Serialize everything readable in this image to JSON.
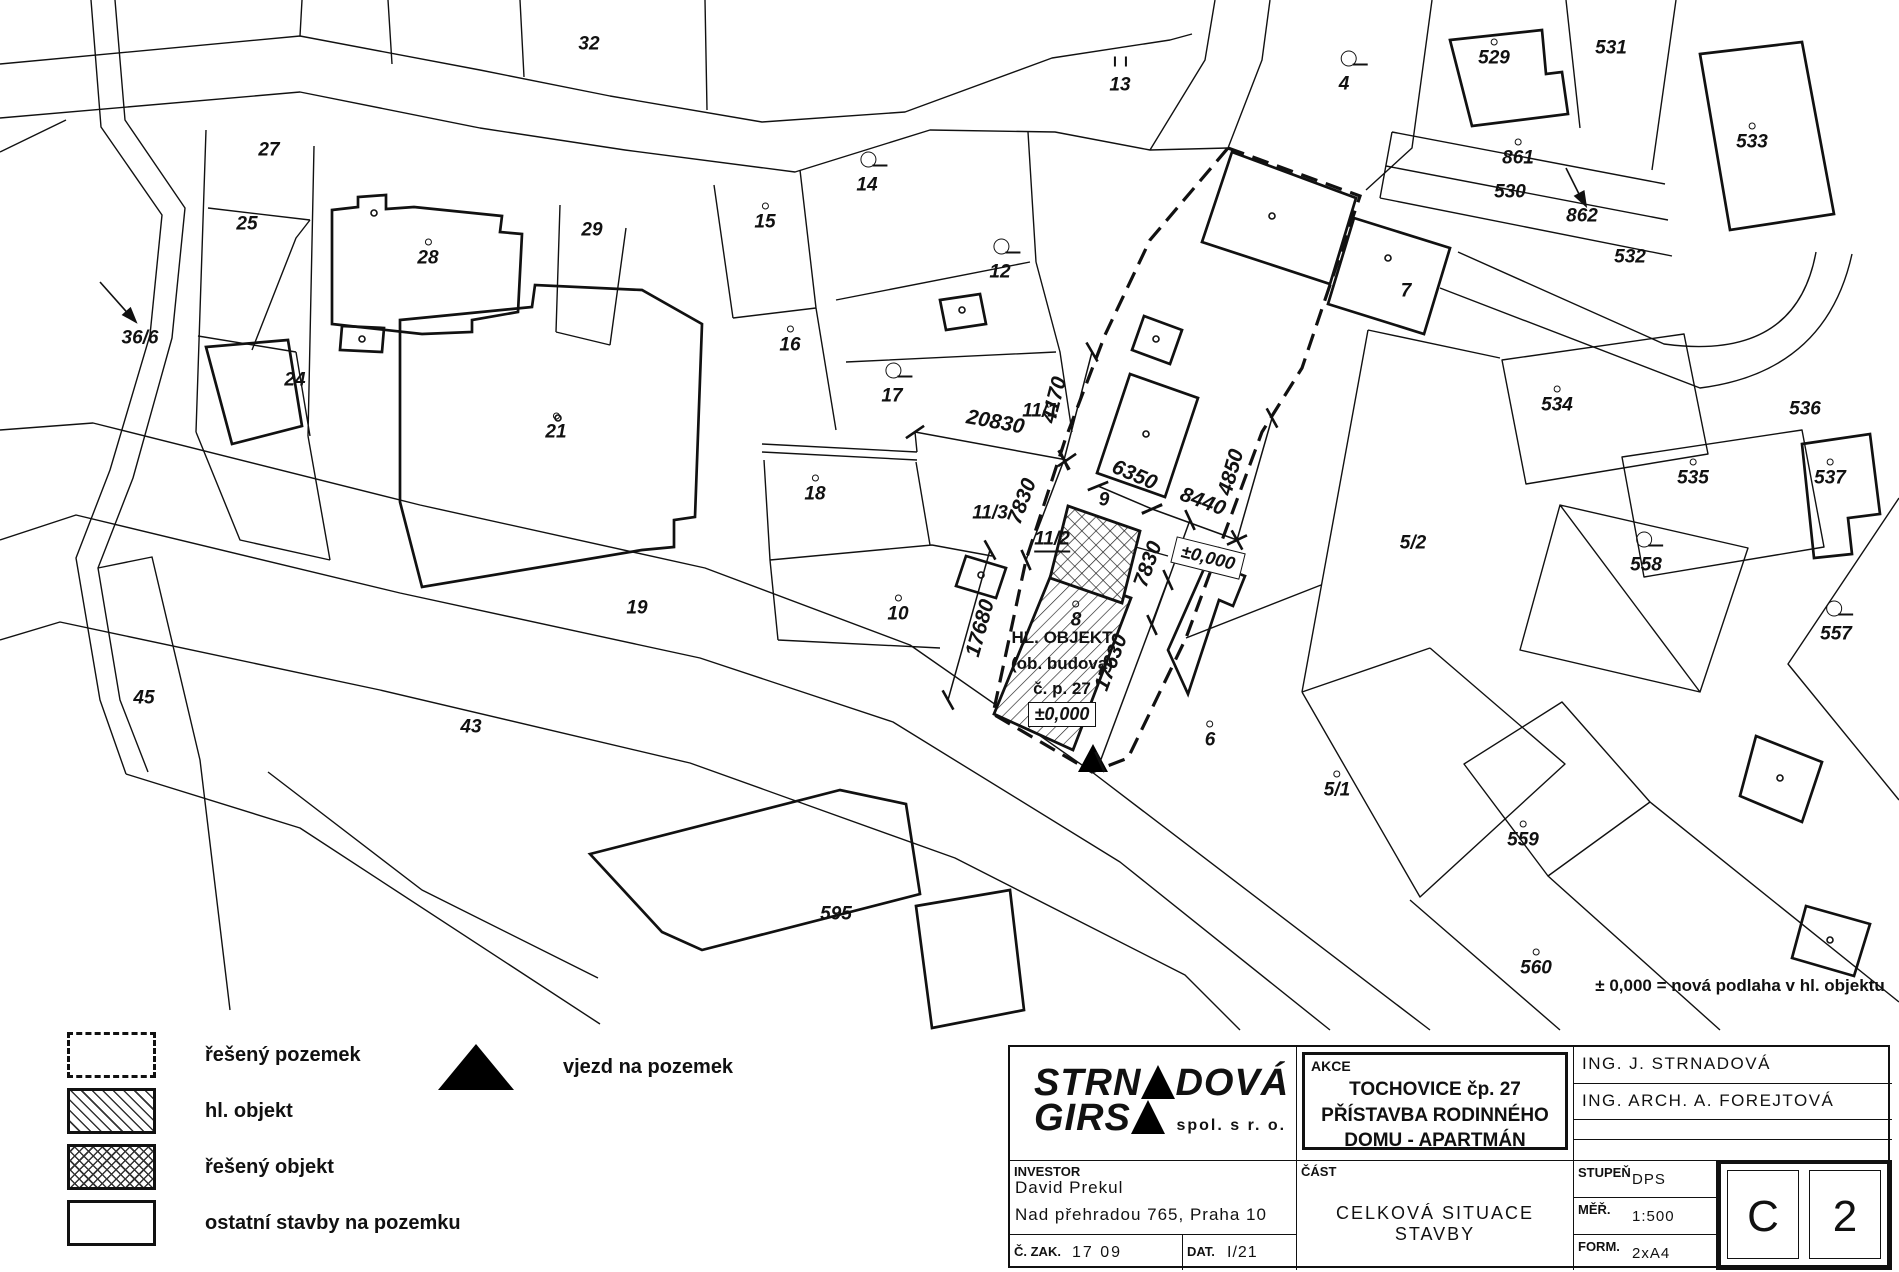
{
  "colors": {
    "ink": "#111111",
    "paper": "#ffffff"
  },
  "map": {
    "parcel_labels": [
      {
        "text": "32",
        "x": 589,
        "y": 44,
        "marker": "none"
      },
      {
        "text": "13",
        "x": 1120,
        "y": 85,
        "marker": "bars"
      },
      {
        "text": "4",
        "x": 1344,
        "y": 84,
        "marker": "circle"
      },
      {
        "text": "529",
        "x": 1494,
        "y": 58,
        "marker": "dot"
      },
      {
        "text": "531",
        "x": 1611,
        "y": 48,
        "marker": "none"
      },
      {
        "text": "533",
        "x": 1752,
        "y": 142,
        "marker": "dot"
      },
      {
        "text": "27",
        "x": 269,
        "y": 150,
        "marker": "none"
      },
      {
        "text": "25",
        "x": 247,
        "y": 224,
        "marker": "none"
      },
      {
        "text": "28",
        "x": 428,
        "y": 258,
        "marker": "dot"
      },
      {
        "text": "29",
        "x": 592,
        "y": 230,
        "marker": "none"
      },
      {
        "text": "15",
        "x": 765,
        "y": 222,
        "marker": "dot"
      },
      {
        "text": "14",
        "x": 867,
        "y": 185,
        "marker": "circle"
      },
      {
        "text": "861",
        "x": 1518,
        "y": 158,
        "marker": "dot"
      },
      {
        "text": "530",
        "x": 1510,
        "y": 192,
        "marker": "none"
      },
      {
        "text": "862",
        "x": 1582,
        "y": 216,
        "marker": "none"
      },
      {
        "text": "532",
        "x": 1630,
        "y": 257,
        "marker": "none"
      },
      {
        "text": "12",
        "x": 1000,
        "y": 272,
        "marker": "circle"
      },
      {
        "text": "16",
        "x": 790,
        "y": 345,
        "marker": "dot"
      },
      {
        "text": "7",
        "x": 1406,
        "y": 291,
        "marker": "none"
      },
      {
        "text": "36/6",
        "x": 140,
        "y": 338,
        "marker": "none"
      },
      {
        "text": "24",
        "x": 295,
        "y": 380,
        "marker": "none"
      },
      {
        "text": "21",
        "x": 556,
        "y": 432,
        "marker": "dot"
      },
      {
        "text": "17",
        "x": 892,
        "y": 396,
        "marker": "circle"
      },
      {
        "text": "11/1",
        "x": 1040,
        "y": 411,
        "marker": "none"
      },
      {
        "text": "534",
        "x": 1557,
        "y": 405,
        "marker": "dot"
      },
      {
        "text": "536",
        "x": 1805,
        "y": 409,
        "marker": "none"
      },
      {
        "text": "535",
        "x": 1693,
        "y": 478,
        "marker": "dot"
      },
      {
        "text": "537",
        "x": 1830,
        "y": 478,
        "marker": "dot"
      },
      {
        "text": "18",
        "x": 815,
        "y": 494,
        "marker": "dot"
      },
      {
        "text": "9",
        "x": 1104,
        "y": 500,
        "marker": "none"
      },
      {
        "text": "11/3",
        "x": 990,
        "y": 513,
        "marker": "none"
      },
      {
        "text": "11/2",
        "x": 1052,
        "y": 541,
        "marker": "underline"
      },
      {
        "text": "5/2",
        "x": 1413,
        "y": 543,
        "marker": "none"
      },
      {
        "text": "558",
        "x": 1646,
        "y": 565,
        "marker": "circle"
      },
      {
        "text": "19",
        "x": 637,
        "y": 608,
        "marker": "none"
      },
      {
        "text": "10",
        "x": 898,
        "y": 614,
        "marker": "dot"
      },
      {
        "text": "8",
        "x": 1076,
        "y": 620,
        "marker": "dot"
      },
      {
        "text": "557",
        "x": 1836,
        "y": 634,
        "marker": "circle"
      },
      {
        "text": "45",
        "x": 144,
        "y": 698,
        "marker": "none"
      },
      {
        "text": "43",
        "x": 471,
        "y": 727,
        "marker": "none"
      },
      {
        "text": "6",
        "x": 1210,
        "y": 740,
        "marker": "dot"
      },
      {
        "text": "5/1",
        "x": 1337,
        "y": 790,
        "marker": "dot"
      },
      {
        "text": "559",
        "x": 1523,
        "y": 840,
        "marker": "dot"
      },
      {
        "text": "595",
        "x": 836,
        "y": 914,
        "marker": "none"
      },
      {
        "text": "560",
        "x": 1536,
        "y": 968,
        "marker": "dot"
      }
    ],
    "dimensions": [
      {
        "text": "20830",
        "x1": 915,
        "y1": 432,
        "x2": 1067,
        "y2": 460,
        "side": -1
      },
      {
        "text": "4170",
        "x1": 1092,
        "y1": 352,
        "x2": 1064,
        "y2": 460,
        "side": 1
      },
      {
        "text": "6350",
        "x1": 1098,
        "y1": 486,
        "x2": 1152,
        "y2": 509,
        "side": -1
      },
      {
        "text": "8440",
        "x1": 1152,
        "y1": 509,
        "x2": 1237,
        "y2": 540,
        "side": -1
      },
      {
        "text": "4850",
        "x1": 1272,
        "y1": 418,
        "x2": 1237,
        "y2": 540,
        "side": 1
      },
      {
        "text": "7830",
        "x1": 1064,
        "y1": 460,
        "x2": 1026,
        "y2": 560,
        "side": 1
      },
      {
        "text": "7830",
        "x1": 1190,
        "y1": 520,
        "x2": 1152,
        "y2": 625,
        "side": 1
      },
      {
        "text": "17680",
        "x1": 990,
        "y1": 550,
        "x2": 948,
        "y2": 700,
        "side": -1
      },
      {
        "text": "17630",
        "x1": 1168,
        "y1": 580,
        "x2": 1100,
        "y2": 762,
        "side": 1
      }
    ],
    "level_box": {
      "text": "±0,000",
      "x": 1208,
      "y": 558,
      "rot": 14
    },
    "main_building": {
      "line1": "HL. OBJEKT",
      "line2": "(ob. budova)",
      "line3": "č. p. 27",
      "level": "±0,000"
    },
    "note": "± 0,000 = nová podlaha v hl. objektu"
  },
  "legend": {
    "items": [
      {
        "label": "řešený pozemek",
        "swatch": "dashed"
      },
      {
        "label": "hl. objekt",
        "swatch": "hatch"
      },
      {
        "label": "řešený objekt",
        "swatch": "crosshatch"
      },
      {
        "label": "ostatní stavby na pozemku",
        "swatch": "plain"
      }
    ],
    "entrance_label": "vjezd na pozemek"
  },
  "titleblock": {
    "company": {
      "top_left": "STRN",
      "top_right": "DOVÁ",
      "bottom_left": "GIRS",
      "tagline": "spol. s r. o."
    },
    "akce": {
      "label": "AKCE",
      "line1": "TOCHOVICE čp. 27",
      "line2": "PŘÍSTAVBA RODINNÉHO",
      "line3": "DOMU -  APARTMÁN"
    },
    "engineers": [
      "ING. J. STRNADOVÁ",
      "ING. ARCH. A. FOREJTOVÁ",
      "",
      ""
    ],
    "investor": {
      "label": "INVESTOR",
      "name": "David Prekul",
      "address": "Nad přehradou 765, Praha 10"
    },
    "czak": {
      "label": "Č. ZAK.",
      "value": "17 09"
    },
    "dat": {
      "label": "DAT.",
      "value": "I/21"
    },
    "cast": {
      "label": "ČÁST",
      "value": "CELKOVÁ SITUACE STAVBY"
    },
    "stupen": {
      "label": "STUPEŇ",
      "value": "DPS"
    },
    "mer": {
      "label": "MĚŘ.",
      "value": "1:500"
    },
    "form": {
      "label": "FORM.",
      "value": "2xA4"
    },
    "sheet": {
      "letter": "C",
      "number": "2"
    }
  }
}
